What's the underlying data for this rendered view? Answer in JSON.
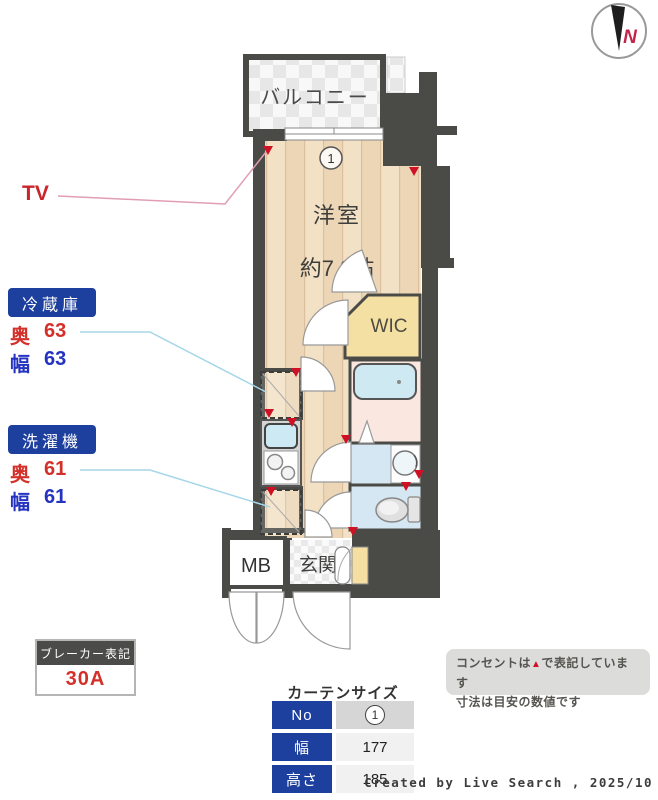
{
  "plan": {
    "balcony": "バルコニー",
    "window_no": "1",
    "room_name": "洋室",
    "room_size": "約7.3帖",
    "wic": "WIC",
    "mb": "MB",
    "entrance": "玄関"
  },
  "compass": {
    "north": "N"
  },
  "tv": {
    "label": "TV"
  },
  "fridge": {
    "title": "冷蔵庫",
    "rows": [
      {
        "label": "奥",
        "value": "63"
      },
      {
        "label": "幅",
        "value": "63"
      }
    ]
  },
  "washer": {
    "title": "洗濯機",
    "rows": [
      {
        "label": "奥",
        "value": "61"
      },
      {
        "label": "幅",
        "value": "61"
      }
    ]
  },
  "breaker": {
    "title": "ブレーカー表記",
    "value": "30A"
  },
  "curtain": {
    "title": "カーテンサイズ",
    "rows": [
      {
        "label": "No",
        "value": "1"
      },
      {
        "label": "幅",
        "value": "177"
      },
      {
        "label": "高さ",
        "value": "185"
      }
    ]
  },
  "note": {
    "line1_pre": "コンセントは",
    "symbol": "▲",
    "line1_post": "で表記しています",
    "line2": "寸法は目安の数値です"
  },
  "credit": "Created by Live Search , 2025/10",
  "colors": {
    "wall": "#4a4a47",
    "floor_stripe": "#f3e1c6",
    "accent_blue": "#1d3f9e",
    "marker_red": "#cf1126",
    "value_red": "#d3302a",
    "value_blue": "#2433c0",
    "water_blue": "#cfe9f2",
    "wic_yellow": "#f5e0a4",
    "bath_pink": "#fae7e0"
  }
}
